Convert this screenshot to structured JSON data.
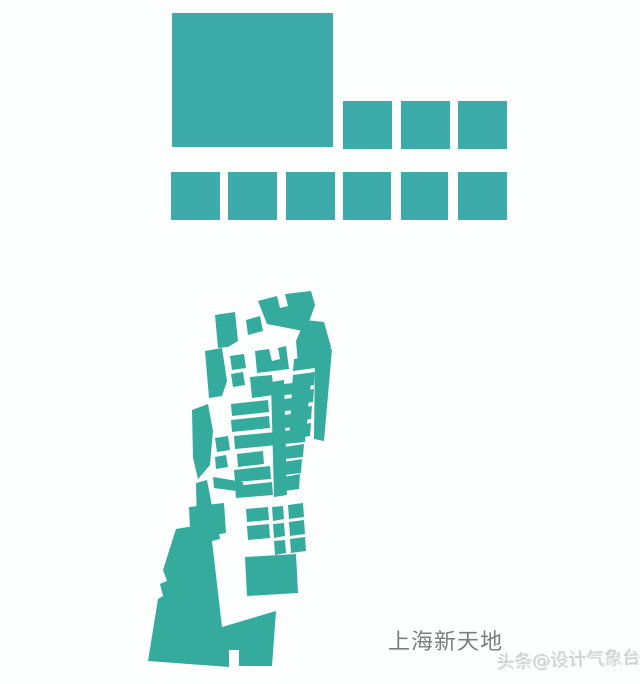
{
  "labels": {
    "site_name": "上海新天地",
    "watermark": "头条@设计气象台"
  },
  "colors": {
    "background": "#fdfefe",
    "block_fill": "#3cabaa",
    "map_fill": "#35ab9e",
    "site_label": "#7d7d7d",
    "watermark": "rgba(185,185,185,0.5)"
  },
  "massing_blocks": {
    "big_square": {
      "x": 172,
      "y": 13,
      "w": 161,
      "h": 134
    },
    "row_top": [
      {
        "x": 343,
        "y": 101,
        "w": 49,
        "h": 48
      },
      {
        "x": 401,
        "y": 101,
        "w": 49,
        "h": 48
      },
      {
        "x": 458,
        "y": 101,
        "w": 49,
        "h": 48
      }
    ],
    "row_bottom": [
      {
        "x": 171,
        "y": 172,
        "w": 49,
        "h": 48
      },
      {
        "x": 228,
        "y": 172,
        "w": 49,
        "h": 48
      },
      {
        "x": 286,
        "y": 172,
        "w": 49,
        "h": 48
      },
      {
        "x": 343,
        "y": 172,
        "w": 48,
        "h": 48
      },
      {
        "x": 401,
        "y": 172,
        "w": 47,
        "h": 48
      },
      {
        "x": 458,
        "y": 172,
        "w": 49,
        "h": 48
      }
    ]
  },
  "figure_ground_map": {
    "polygons": [
      "258,301 277,296 280,308 288,306 285,294 311,291 315,305 310,319 303,331 267,324",
      "296,341 305,320 324,322 331,347 327,362 298,364",
      "215,315 235,312 238,341 228,347 218,348",
      "246,320 260,316 263,331 248,335",
      "255,351 269,349 272,361 280,359 278,348 286,346 289,369 257,373",
      "205,351 222,348 227,381 222,396 209,398",
      "230,356 244,354 246,368 232,370",
      "231,374 243,372 245,385 233,387",
      "250,377 272,375 274,395 252,398",
      "315,351 332,349 324,441 314,439",
      "294,359 316,356 315,368 293,371",
      "293,375 315,372 314,385 292,388",
      "292,392 314,389 313,402 291,405",
      "291,409 312,406 311,419 290,422",
      "290,426 311,423 310,436 289,439",
      "271,382 284,380 287,495 274,497",
      "284,384 311,381 310,393 284,395",
      "284,399 309,396 308,409 284,411",
      "284,415 308,412 307,426 284,428",
      "284,431 306,428 305,442 284,444",
      "284,447 304,444 303,457 284,459",
      "284,462 302,459 301,473 284,475",
      "284,477 300,474 299,489 284,491",
      "231,404 268,400 269,412 232,416",
      "231,420 269,416 270,428 232,432",
      "234,436 276,432 277,445 235,449",
      "237,454 263,451 264,464 238,467",
      "234,470 270,466 271,479 235,482",
      "235,486 272,482 273,495 236,498",
      "192,410 208,404 213,431 210,465 198,479 193,458",
      "215,438 228,436 230,450 217,452",
      "215,457 226,455 228,467 216,469",
      "213,477 243,482 244,492 214,488",
      "196,483 207,480 212,506 204,529 197,527",
      "189,507 224,503 226,533 208,536 207,527 190,529",
      "246,509 268,507 269,520 247,522",
      "272,507 283,506 284,519 273,521",
      "288,505 303,503 304,517 289,519",
      "247,526 269,524 270,538 248,540",
      "273,524 284,523 285,536 274,538",
      "289,522 304,520 305,534 290,536",
      "274,541 285,540 286,553 275,555",
      "290,539 305,537 306,551 291,553",
      "245,557 296,554 298,593 247,596",
      "176,529 217,522 220,539 212,541 222,627 276,611 272,666 239,666 239,650 229,650 229,667 148,661 158,599 163,596 160,584 167,581 163,570"
    ]
  }
}
